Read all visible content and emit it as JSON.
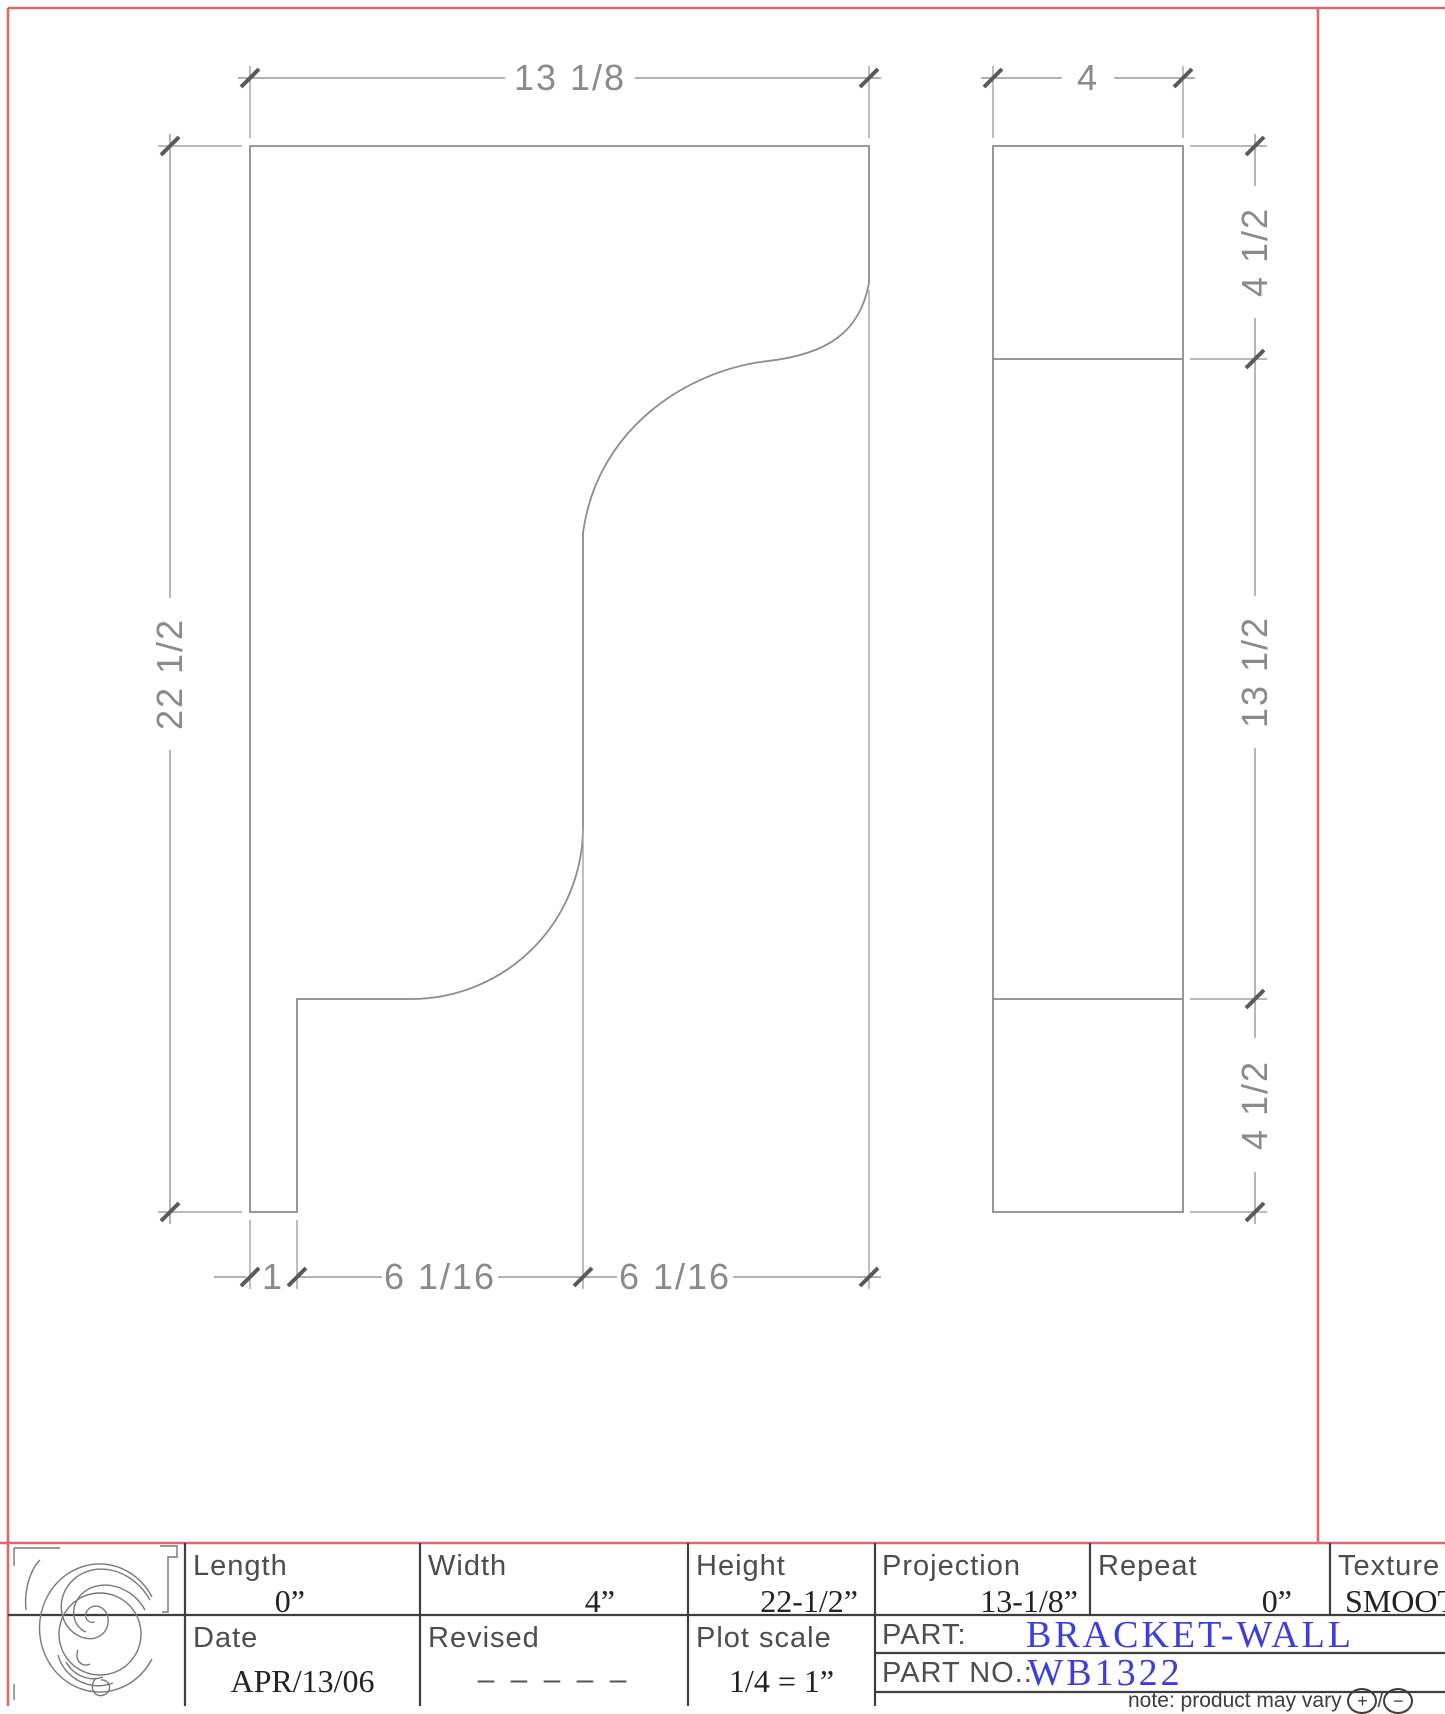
{
  "drawing": {
    "profile_view": {
      "width_dim": "13 1/8",
      "height_dim": "22 1/2",
      "bottom_dims": [
        "1",
        "6 1/16",
        "6 1/16"
      ]
    },
    "front_view": {
      "width_dim": "4",
      "right_dims": [
        "4 1/2",
        "13 1/2",
        "4 1/2"
      ]
    }
  },
  "title_block": {
    "specs": [
      {
        "label": "Length",
        "value": "0”"
      },
      {
        "label": "Width",
        "value": "4”"
      },
      {
        "label": "Height",
        "value": "22-1/2”"
      },
      {
        "label": "Projection",
        "value": "13-1/8”"
      },
      {
        "label": "Repeat",
        "value": "0”"
      },
      {
        "label": "Texture",
        "value": "SMOOTH"
      }
    ],
    "date_label": "Date",
    "date_value": "APR/13/06",
    "revised_label": "Revised",
    "revised_value": "– – – – –",
    "plot_scale_label": "Plot  scale",
    "plot_scale_value": "1/4 = 1”",
    "part_label": "PART:",
    "part_value": "BRACKET-WALL",
    "part_no_label": "PART  NO.:",
    "part_no_value": "WB1322",
    "note_prefix": "note: product may vary",
    "note_plus": "+",
    "note_slash": "/",
    "note_minus": "−",
    "accent_blue": "#3c3ce0",
    "border_red": "#d96b6b"
  }
}
